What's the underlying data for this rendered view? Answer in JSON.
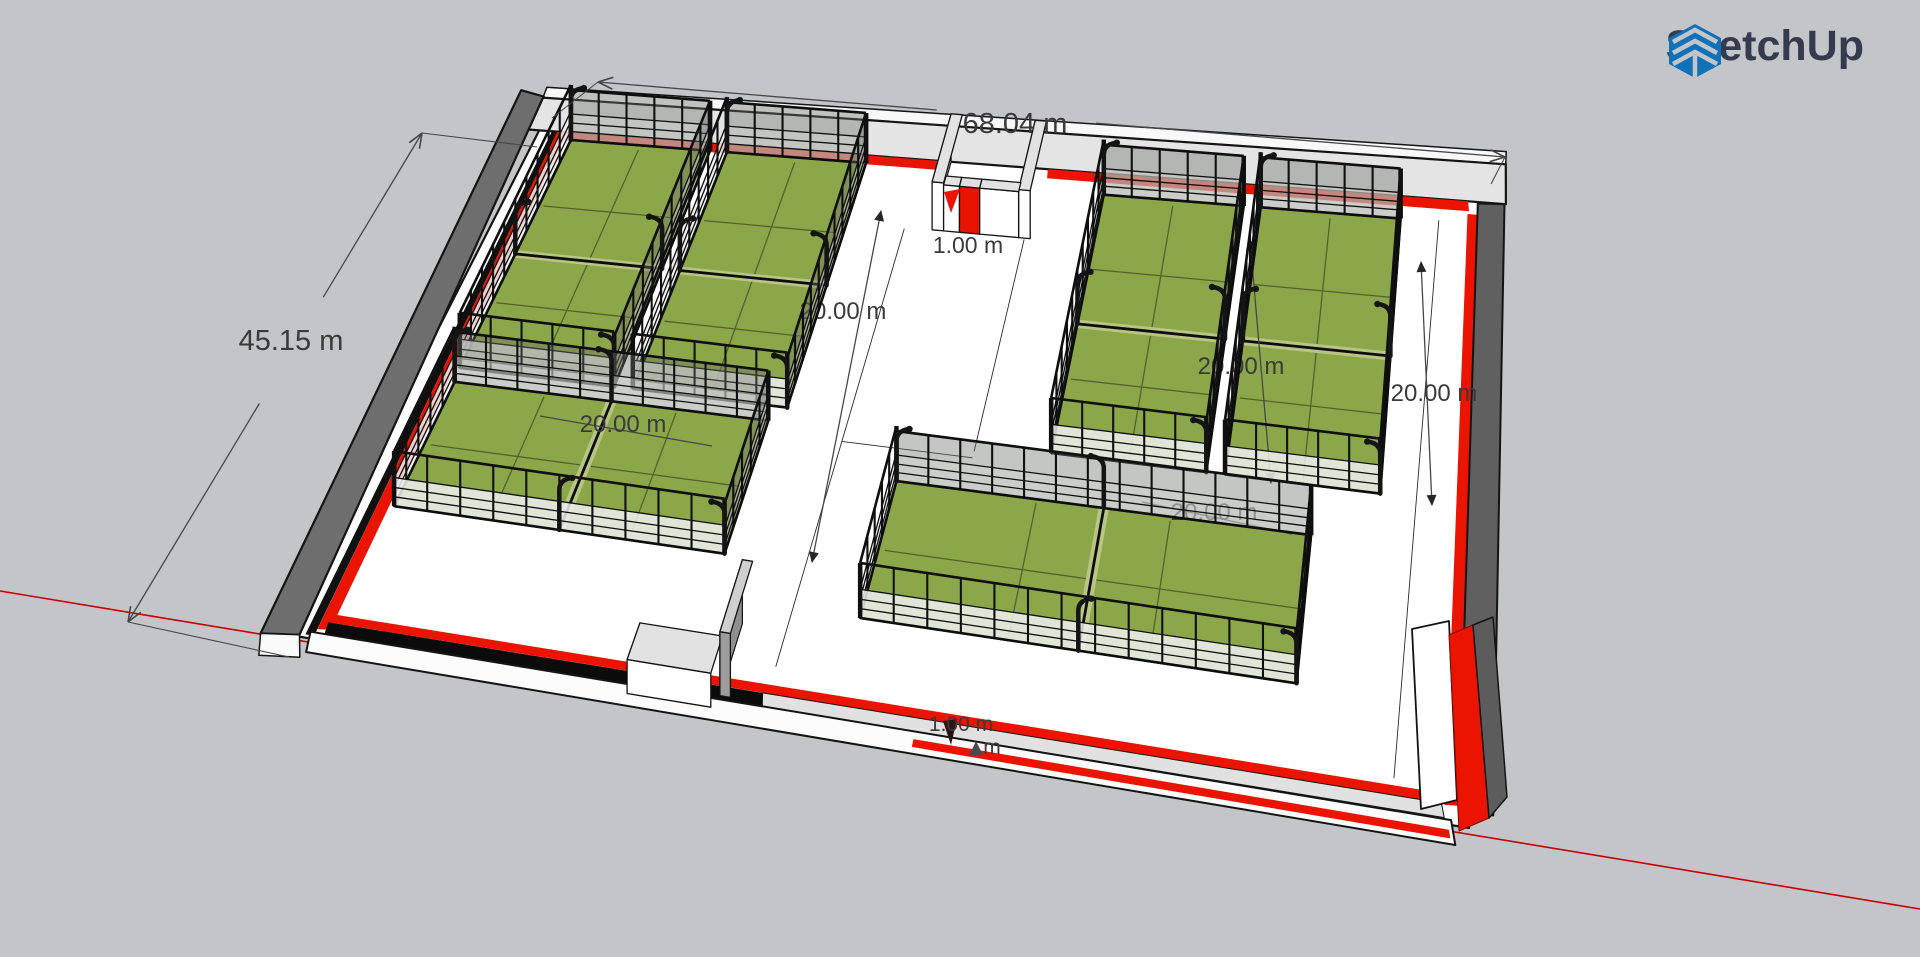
{
  "app": {
    "brand": "SketchUp"
  },
  "colors": {
    "bg": "#c4c5c9",
    "floor": "#ffffff",
    "ink": "#141414",
    "red": "#ea1400",
    "axisRed": "#c40000",
    "green": "#8ca74a",
    "greenLine": "#55622e",
    "netBand": "#b9c583",
    "wallDark": "#6e6e6e",
    "wallLight": "#e4e4e4",
    "dimLine": "#474747",
    "dimText": "#3a3a3a",
    "glassFarFull": "rgba(108,112,104,0.40)",
    "glassFarLow": "rgba(210,212,208,0.50)",
    "glassNearLow": "rgba(240,240,240,0.85)",
    "logoBlue": "#1171b8",
    "logoText": "#343b4e"
  },
  "scene": {
    "plan": {
      "w": 68.04,
      "h": 45.15
    },
    "quad": [
      [
        545,
        119
      ],
      [
        1493,
        189
      ],
      [
        1469,
        828
      ],
      [
        283,
        634
      ]
    ],
    "axis": {
      "a": [
        0,
        591
      ],
      "b": [
        1920,
        909
      ]
    },
    "floor": [
      [
        0,
        0
      ],
      [
        68.04,
        0
      ],
      [
        68.04,
        45.15
      ],
      [
        0,
        45.15
      ]
    ],
    "wallBands": [
      {
        "pts": [
          [
            -1.0,
            -2.7
          ],
          [
            68.9,
            -2.7
          ],
          [
            68.9,
            -1.8
          ],
          [
            -0.9,
            -1.8
          ]
        ],
        "fill": "#f8f8f8",
        "stroke": "#141414",
        "sw": 1.5
      },
      {
        "pts": [
          [
            -0.9,
            -1.8
          ],
          [
            68.9,
            -1.8
          ],
          [
            69.0,
            1.0
          ],
          [
            -0.9,
            1.0
          ]
        ],
        "fill": "#e4e4e4",
        "stroke": "#141414",
        "sw": 2.2
      },
      {
        "pts": [
          [
            2.0,
            1.0
          ],
          [
            29.3,
            1.0
          ],
          [
            29.4,
            1.7
          ],
          [
            2.1,
            1.7
          ]
        ],
        "fill": "#ea1400"
      },
      {
        "pts": [
          [
            36.3,
            1.0
          ],
          [
            66.3,
            1.0
          ],
          [
            66.4,
            1.7
          ],
          [
            36.4,
            1.7
          ]
        ],
        "fill": "#ea1400"
      },
      {
        "pts": [
          [
            66.3,
            1.9
          ],
          [
            67.0,
            1.9
          ],
          [
            67.4,
            43.7
          ],
          [
            66.6,
            43.8
          ]
        ],
        "fill": "#ea1400"
      },
      {
        "pts": [
          [
            67.0,
            1.1
          ],
          [
            68.9,
            1.0
          ],
          [
            69.4,
            44.0
          ],
          [
            67.4,
            43.7
          ]
        ],
        "fill": "#606060",
        "stroke": "#141414",
        "sw": 2
      },
      {
        "pts": [
          [
            -2.7,
            -2.3
          ],
          [
            -0.9,
            -1.9
          ],
          [
            0.9,
            45.0
          ],
          [
            -1.2,
            45.4
          ]
        ],
        "fill": "#6e6e6e",
        "stroke": "#141414",
        "sw": 2.2
      },
      {
        "pts": [
          [
            0.9,
            0.9
          ],
          [
            1.3,
            0.9
          ],
          [
            1.7,
            44.8
          ],
          [
            1.2,
            44.9
          ]
        ],
        "fill": "#101010"
      },
      {
        "pts": [
          [
            1.3,
            1.0
          ],
          [
            2.0,
            1.0
          ],
          [
            2.4,
            44.2
          ],
          [
            1.7,
            44.3
          ]
        ],
        "fill": "#ea1400"
      },
      {
        "pts": [
          [
            -1.2,
            45.4
          ],
          [
            0.9,
            45.0
          ],
          [
            1.5,
            46.8
          ],
          [
            -0.7,
            47.2
          ]
        ],
        "fill": "#fafafa",
        "stroke": "#141414",
        "sw": 1.5
      },
      {
        "pts": [
          [
            2.0,
            42.9
          ],
          [
            66.3,
            43.0
          ],
          [
            66.4,
            43.7
          ],
          [
            2.1,
            43.6
          ]
        ],
        "fill": "#ea1400"
      },
      {
        "pts": [
          [
            2.1,
            43.6
          ],
          [
            27.2,
            43.66
          ],
          [
            27.4,
            44.7
          ],
          [
            2.2,
            44.6
          ]
        ],
        "fill": "#0b0b0b"
      },
      {
        "pts": [
          [
            27.2,
            43.66
          ],
          [
            66.4,
            43.7
          ],
          [
            66.6,
            44.7
          ],
          [
            27.4,
            44.7
          ]
        ],
        "fill": "#e1e1e1",
        "stroke": "#141414",
        "sw": 1
      },
      {
        "pts": [
          [
            1.4,
            44.6
          ],
          [
            67.0,
            44.8
          ],
          [
            67.3,
            46.5
          ],
          [
            1.7,
            46.3
          ]
        ],
        "fill": "#fcfcfc",
        "stroke": "#141414",
        "sw": 2
      },
      {
        "pts": [
          [
            36.2,
            45.3
          ],
          [
            66.9,
            45.5
          ],
          [
            67.0,
            46.1
          ],
          [
            36.2,
            45.9
          ]
        ],
        "fill": "#ea1400"
      }
    ],
    "boxes": [
      {
        "u0": 29.4,
        "v0": 1.0,
        "u1": 30.2,
        "v1": 6.4,
        "h": 48
      },
      {
        "u0": 35.4,
        "v0": 1.0,
        "u1": 36.2,
        "v1": 6.4,
        "h": 48
      },
      {
        "u0": 30.2,
        "v0": 5.7,
        "u1": 31.3,
        "v1": 6.4,
        "h": 46
      },
      {
        "u0": 31.3,
        "v0": 5.7,
        "u1": 32.7,
        "v1": 6.4,
        "h": 46,
        "front": "#e81400",
        "top": "#e0e0e0"
      },
      {
        "u0": 32.7,
        "v0": 5.7,
        "u1": 35.4,
        "v1": 6.4,
        "h": 46
      },
      {
        "u0": 19.8,
        "v0": 42.4,
        "u1": 24.6,
        "v1": 45.4,
        "h": 34
      },
      {
        "u0": 24.9,
        "v0": 38.6,
        "u1": 25.5,
        "v1": 44.4,
        "h": 64,
        "front": "#9c9c9c",
        "top": "#cfcfcf",
        "side": "#8f8f8f"
      }
    ],
    "floorLines": [
      [
        27.5,
        6.5,
        27.5,
        41.5
      ],
      [
        35.8,
        6.5,
        35.8,
        23.0
      ],
      [
        27.5,
        23.5,
        35.8,
        23.5
      ],
      [
        64.3,
        2.5,
        63.6,
        42.5
      ]
    ],
    "courts": [
      {
        "id": "court-tl-1",
        "u0": 2.5,
        "v0": 1.6,
        "u1": 12.4,
        "v1": 21.4,
        "net": "h"
      },
      {
        "id": "court-tl-2",
        "u0": 13.6,
        "v0": 1.6,
        "u1": 23.5,
        "v1": 21.4,
        "net": "h"
      },
      {
        "id": "court-tr-1",
        "u0": 40.6,
        "v0": 2.6,
        "u1": 50.5,
        "v1": 22.4,
        "net": "h"
      },
      {
        "id": "court-tr-2",
        "u0": 51.7,
        "v0": 2.6,
        "u1": 61.6,
        "v1": 22.4,
        "net": "h"
      },
      {
        "id": "court-bl",
        "u0": 2.6,
        "v0": 22.6,
        "u1": 22.6,
        "v1": 33.4,
        "net": "v"
      },
      {
        "id": "court-br",
        "u0": 31.5,
        "v0": 26.0,
        "u1": 57.5,
        "v1": 36.8,
        "net": "v"
      }
    ],
    "extras": [
      {
        "name": "se-corner-white-wall",
        "pts": [
          [
            1412,
            629
          ],
          [
            1449,
            621
          ],
          [
            1457,
            800
          ],
          [
            1421,
            809
          ]
        ],
        "fill": "#ffffff",
        "stroke": "#141414",
        "sw": 1.8
      },
      {
        "name": "se-corner-red-wall",
        "pts": [
          [
            1449,
            635
          ],
          [
            1473,
            625
          ],
          [
            1489,
            818
          ],
          [
            1459,
            831
          ]
        ],
        "fill": "#ea1400",
        "stroke": "#7a0c06",
        "sw": 1
      },
      {
        "name": "se-corner-dark-wall",
        "pts": [
          [
            1473,
            625
          ],
          [
            1493,
            617
          ],
          [
            1507,
            797
          ],
          [
            1489,
            818
          ]
        ],
        "fill": "#5c5c5c",
        "stroke": "#141414",
        "sw": 1.5
      },
      {
        "name": "entrance-red-arrow",
        "pts": [
          [
            944,
            192
          ],
          [
            960,
            189
          ],
          [
            951,
            213
          ]
        ],
        "fill": "#ea1400"
      },
      {
        "name": "bottom-dark-arrow",
        "pts": [
          [
            943,
            721
          ],
          [
            957,
            719
          ],
          [
            951,
            745
          ]
        ],
        "fill": "#2c1210"
      },
      {
        "name": "bottom-gray-arrow",
        "pts": [
          [
            969,
            756
          ],
          [
            976,
            741
          ],
          [
            983,
            755
          ]
        ],
        "fill": "#4a4a4a"
      }
    ],
    "dims": [
      {
        "label": "20.00 m",
        "a": [
          881,
          211
        ],
        "b": [
          812,
          562
        ],
        "tx": 843,
        "ty": 319,
        "size": 24,
        "arrow": "tri",
        "layer": "under"
      },
      {
        "label": "20.00 m",
        "a": [
          1250,
          240
        ],
        "b": [
          1271,
          483
        ],
        "tx": 1241,
        "ty": 374,
        "size": 24,
        "arrow": "tri",
        "layer": "under"
      },
      {
        "label": "20.00 m",
        "a": [
          1421,
          262
        ],
        "b": [
          1432,
          505
        ],
        "tx": 1434,
        "ty": 401,
        "size": 24,
        "arrow": "tri",
        "layer": "under"
      },
      {
        "label": "20.00 m",
        "a": [
          540,
          416
        ],
        "b": [
          712,
          446
        ],
        "tx": 623,
        "ty": 432,
        "size": 24,
        "arrow": "none",
        "layer": "under"
      },
      {
        "label": "20.00 m",
        "a": [
          1142,
          502
        ],
        "b": [
          1292,
          534
        ],
        "tx": 1214,
        "ty": 520,
        "size": 24,
        "arrow": "none",
        "layer": "under"
      },
      {
        "label": "68.04 m",
        "a": [
          598,
          82
        ],
        "b": [
          1505,
          157
        ],
        "tx": 1015,
        "ty": 133,
        "gap": 80,
        "size": 29,
        "arrow": "open",
        "layer": "over",
        "exts": [
          [
            [
              598,
              82
            ],
            [
              552,
              118
            ]
          ],
          [
            [
              1505,
              157
            ],
            [
              1491,
              184
            ]
          ]
        ]
      },
      {
        "label": "45.15 m",
        "a": [
          422,
          133
        ],
        "b": [
          128,
          622
        ],
        "tx": 291,
        "ty": 350,
        "gap": 62,
        "size": 29,
        "arrow": "open",
        "layer": "over",
        "exts": [
          [
            [
              422,
              133
            ],
            [
              537,
              147
            ]
          ],
          [
            [
              128,
              622
            ],
            [
              289,
              657
            ]
          ]
        ]
      },
      {
        "label": "1.00 m",
        "tx": 968,
        "ty": 253,
        "size": 23,
        "arrow": "none",
        "layer": "over"
      },
      {
        "label": "1.00 m",
        "tx": 961,
        "ty": 731,
        "size": 21,
        "arrow": "none",
        "layer": "over"
      },
      {
        "label": "m",
        "tx": 992,
        "ty": 754,
        "size": 21,
        "arrow": "none",
        "layer": "over"
      }
    ]
  }
}
